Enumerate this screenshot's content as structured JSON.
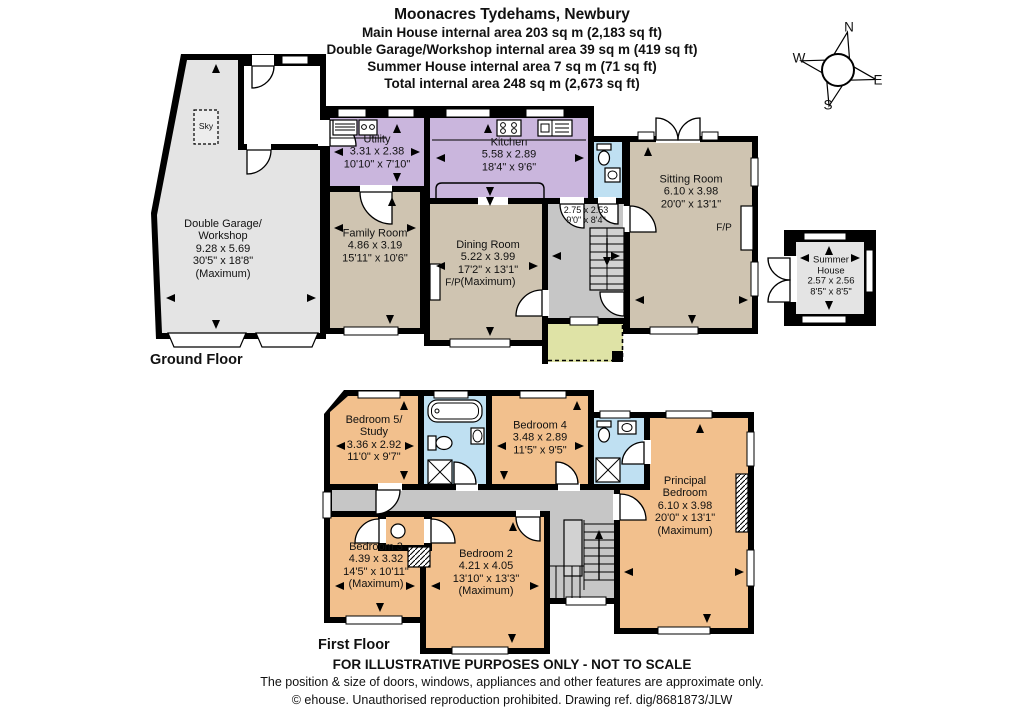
{
  "header": {
    "title": "Moonacres Tydehams, Newbury",
    "lines": [
      "Main House internal area 203 sq m (2,183 sq ft)",
      "Double Garage/Workshop internal area 39 sq m (419 sq ft)",
      "Summer House internal area 7 sq m (71 sq ft)",
      "Total internal area 248 sq m (2,673 sq ft)"
    ]
  },
  "compass": {
    "n": "N",
    "e": "E",
    "s": "S",
    "w": "W"
  },
  "floor_labels": {
    "ground": "Ground Floor",
    "first": "First Floor"
  },
  "annotations": {
    "fireplace": "F/P",
    "skylight": "Sky"
  },
  "rooms": {
    "garage": {
      "lines": [
        "Double Garage/",
        "Workshop",
        "9.28 x 5.69",
        "30'5\" x 18'8\"",
        "(Maximum)"
      ]
    },
    "utility": {
      "lines": [
        "Utility",
        "3.31 x 2.38",
        "10'10\" x 7'10\""
      ]
    },
    "kitchen": {
      "lines": [
        "Kitchen",
        "5.58 x 2.89",
        "18'4\" x 9'6\""
      ]
    },
    "family": {
      "lines": [
        "Family Room",
        "4.86 x 3.19",
        "15'11\" x 10'6\""
      ]
    },
    "dining": {
      "lines": [
        "Dining Room",
        "5.22 x 3.99",
        "17'2\" x 13'1\"",
        "(Maximum)"
      ]
    },
    "hall": {
      "lines": [
        "2.75 x 2.53",
        "9'0\" x 8'4\""
      ]
    },
    "sitting": {
      "lines": [
        "Sitting Room",
        "6.10 x 3.98",
        "20'0\" x 13'1\""
      ]
    },
    "summer": {
      "lines": [
        "Summer",
        "House",
        "2.57 x 2.56",
        "8'5\" x 8'5\""
      ]
    },
    "bed5": {
      "lines": [
        "Bedroom 5/",
        "Study",
        "3.36 x 2.92",
        "11'0\" x 9'7\""
      ]
    },
    "bed4": {
      "lines": [
        "Bedroom 4",
        "3.48 x 2.89",
        "11'5\" x 9'5\""
      ]
    },
    "principal": {
      "lines": [
        "Principal",
        "Bedroom",
        "6.10 x 3.98",
        "20'0\" x 13'1\"",
        "(Maximum)"
      ]
    },
    "bed3": {
      "lines": [
        "Bedroom 3",
        "4.39 x 3.32",
        "14'5\" x 10'11\"",
        "(Maximum)"
      ]
    },
    "bed2": {
      "lines": [
        "Bedroom 2",
        "4.21 x 4.05",
        "13'10\" x 13'3\"",
        "(Maximum)"
      ]
    }
  },
  "footer": {
    "line1": "FOR ILLUSTRATIVE PURPOSES ONLY - NOT TO SCALE",
    "line2": "The position & size of doors, windows, appliances and other features are approximate only.",
    "line3": "© ehouse. Unauthorised reproduction prohibited. Drawing ref. dig/8681873/JLW"
  },
  "palette": {
    "wall": "#000000",
    "garage_gray": "#e4e4e4",
    "hall_gray": "#c6c6c6",
    "stairs_gray": "#d2d2d2",
    "purple": "#cab6dd",
    "tan": "#cfc4b1",
    "orange": "#f2c08d",
    "blue": "#bfe0f2",
    "green": "#dfe3a6"
  }
}
